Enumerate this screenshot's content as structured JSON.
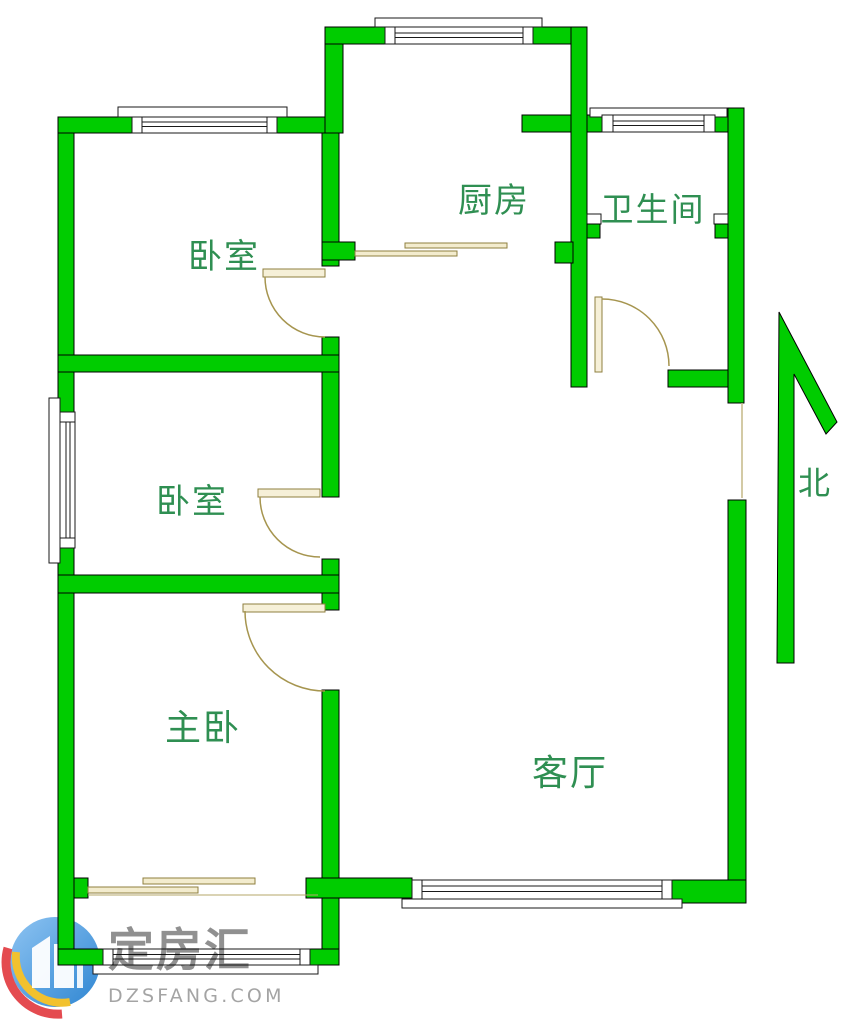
{
  "rooms": [
    {
      "id": "bedroom-1",
      "label": "卧室"
    },
    {
      "id": "bedroom-2",
      "label": "卧室"
    },
    {
      "id": "master-bedroom",
      "label": "主卧"
    },
    {
      "id": "kitchen",
      "label": "厨房"
    },
    {
      "id": "bathroom",
      "label": "卫生间"
    },
    {
      "id": "living-room",
      "label": "客厅"
    }
  ],
  "compass": {
    "label": "北"
  },
  "watermark": {
    "brand": "定房汇",
    "domain": "DZSFANG.COM"
  },
  "colors": {
    "wall_green": "#00cc00",
    "label_green": "#2f8f52",
    "door_tan": "#a6954f",
    "watermark_gray": "#878787",
    "logo_blue": "#4a9de0",
    "logo_red": "#e44b50",
    "logo_yellow": "#f2c12e"
  }
}
